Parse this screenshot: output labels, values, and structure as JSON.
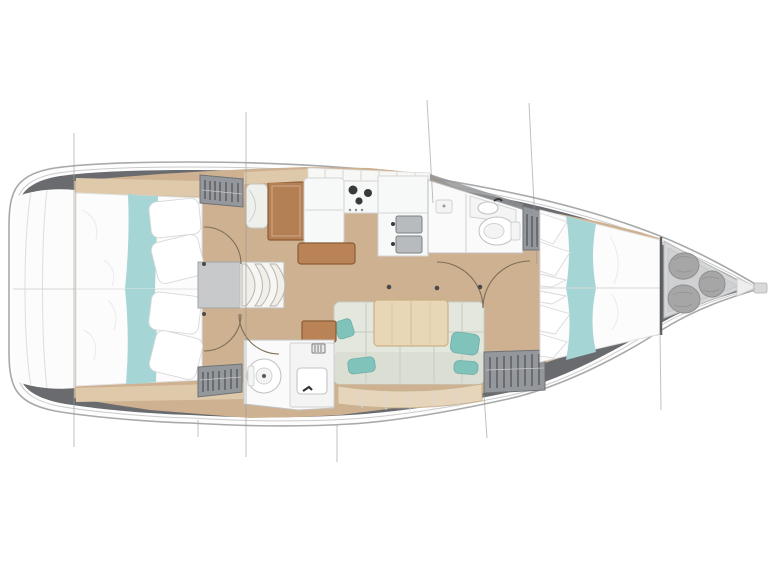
{
  "title": "Sailing yacht interior layout plan, top view, bow pointing right",
  "diagram": {
    "type": "floorplan",
    "orientation": "bow-right",
    "rooms": [
      "aft-cabin-port",
      "aft-cabin-starboard",
      "companionway",
      "nav-station",
      "galley",
      "forward-head",
      "aft-head",
      "salon",
      "forward-cabin",
      "bow-sail-locker",
      "transom"
    ],
    "furniture": {
      "aft_cabin_port": [
        "double-berth",
        "teal-runner",
        "pillows",
        "hanging-locker",
        "shelf"
      ],
      "aft_cabin_starboard": [
        "double-berth",
        "teal-runner",
        "pillows",
        "hanging-locker",
        "shelf"
      ],
      "companionway": [
        "landing",
        "three-steps"
      ],
      "nav_station": [
        "seat",
        "chart-table"
      ],
      "galley": [
        "overhead-lockers",
        "fridge",
        "stove-3-burners",
        "double-sink",
        "island-counter"
      ],
      "forward_head": [
        "shower-tray",
        "glass-partition",
        "washbasin",
        "toilet"
      ],
      "aft_head": [
        "toilet",
        "washbasin",
        "vent-grill"
      ],
      "salon": [
        "u-settee",
        "teal-cushions",
        "dining-table",
        "hull-side-bench",
        "side-cabinet"
      ],
      "forward_cabin": [
        "v-berth",
        "teal-runner",
        "pillows",
        "hanging-locker-top",
        "hanging-locker-bottom"
      ],
      "bow_locker": [
        "sail-bag",
        "sail-bag",
        "sail-bag",
        "bow-plate",
        "anchor-roller"
      ]
    },
    "door_swings": 5,
    "rigging_line_count": 7
  },
  "palette": {
    "hullFill": "#fdfdfd",
    "hullStroke": "#a9a9a9",
    "deckBand": "#696b6e",
    "floorWood": "#cdb191",
    "shelfWood": "#dfc9ab",
    "chartWood": "#b57f54",
    "islandWood": "#b98355",
    "tableWood": "#e8d7b6",
    "benchWood": "#e6d5bb",
    "teal": "#a5d5d4",
    "tealPillow": "#7fc3bb",
    "bedWhite": "#fcfcfc",
    "lockerGray": "#94979b",
    "lockerDark": "#5f6265",
    "landingGray": "#c8c9ca",
    "stepCream": "#f1efe8",
    "roomWhite": "#fafafa",
    "wallGray": "#c2c3c4",
    "cushion": "#e4e7de",
    "cushionSeam": "#c6cabf",
    "sinkSteel": "#b7bbbe",
    "bagGray": "#a6a6a6",
    "bowFloor": "#d5d6d7"
  }
}
